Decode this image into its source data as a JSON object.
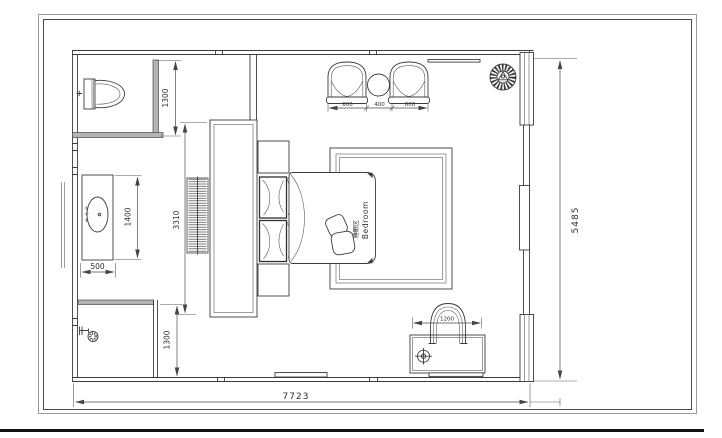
{
  "plan": {
    "zone_label": {
      "zh": "睡眠区",
      "en": "Bedroom"
    },
    "dims": {
      "toilet_depth": "1300",
      "vanity_length": "1400",
      "vanity_width": "500",
      "headboard_wall": "3310",
      "shower_depth": "1300",
      "armchair_left": "600",
      "side_table": "400",
      "armchair_right": "600",
      "desk_chair": "1200",
      "room_depth": "5485",
      "room_width": "7723"
    }
  }
}
